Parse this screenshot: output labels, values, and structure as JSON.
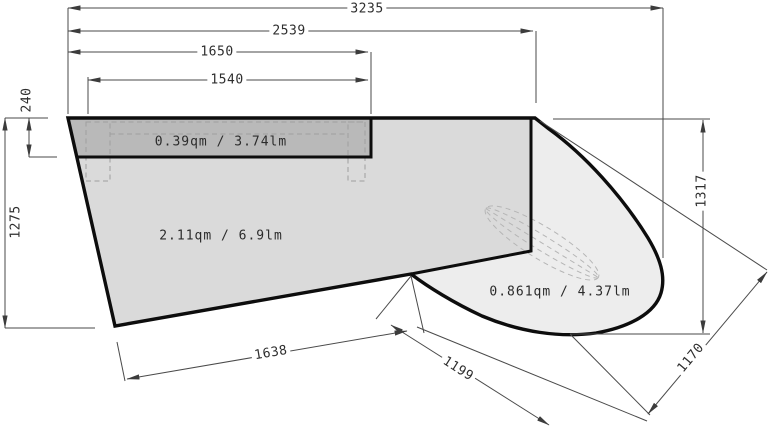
{
  "drawing": {
    "type": "countertop-plan",
    "dim_labels": {
      "overall_width": "3235",
      "width_2539": "2539",
      "width_1650": "1650",
      "width_1540": "1540",
      "band_height": "240",
      "left_height": "1275",
      "bottom_edge": "1638",
      "island_edge_1199": "1199",
      "island_edge_1170": "1170",
      "right_height": "1317"
    },
    "area_labels": {
      "band": "0.39qm / 3.74lm",
      "main": "2.11qm / 6.9lm",
      "island": "0.861qm / 4.37lm"
    },
    "colors": {
      "band_fill": "#b9b9b9",
      "main_fill": "#dadada",
      "island_fill": "#ededed",
      "outline": "#0d0d0d",
      "dim_line": "#4a4a4a",
      "hidden_dash": "#9e9e9e"
    }
  }
}
